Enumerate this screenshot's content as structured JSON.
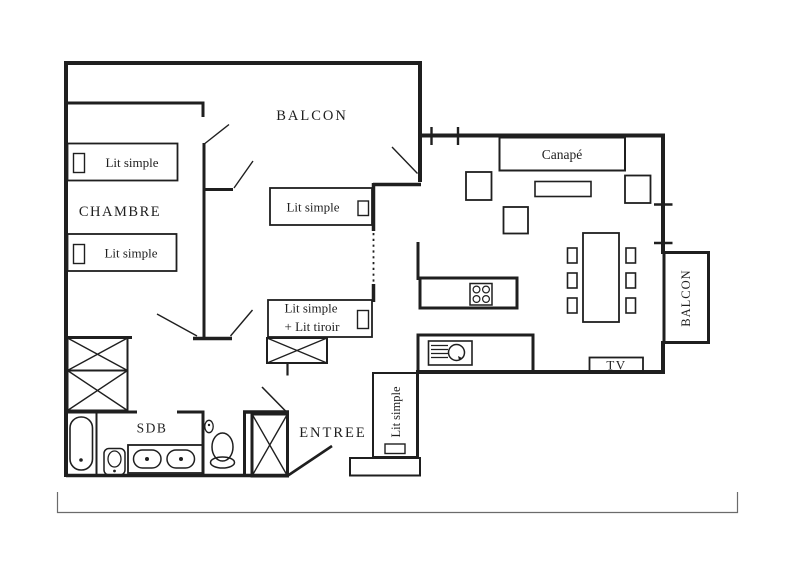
{
  "plan": {
    "labels": {
      "balcon_top": "BALCON",
      "chambre": "CHAMBRE",
      "bed1": "Lit simple",
      "bed2": "Lit simple",
      "bed3": "Lit simple",
      "bed4_line1": "Lit simple",
      "bed4_line2": "+ Lit tiroir",
      "bed5": "Lit simple",
      "canape": "Canapé",
      "sdb": "SDB",
      "entree": "ENTREE",
      "tv": "TV",
      "balcon_right": "BALCON"
    },
    "colors": {
      "line": "#1f1f1f",
      "background": "#ffffff",
      "scale_bar": "#6b6b6b"
    }
  }
}
